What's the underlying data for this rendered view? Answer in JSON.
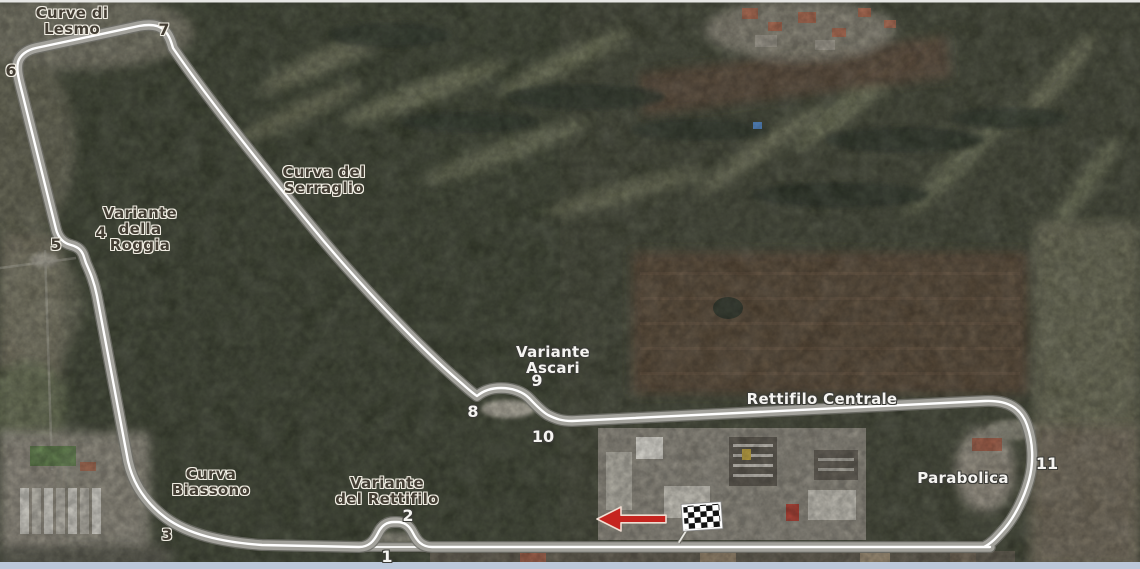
{
  "map": {
    "circuit_labels": [
      {
        "id": "curve-di-lesmo",
        "style": "dark",
        "lines": [
          "Curve di",
          "Lesmo"
        ]
      },
      {
        "id": "variante-della-roggia",
        "style": "dark",
        "lines": [
          "Variante",
          "della",
          "Roggia"
        ]
      },
      {
        "id": "curva-del-serraglio",
        "style": "dark",
        "lines": [
          "Curva del",
          "Serraglio"
        ]
      },
      {
        "id": "variante-ascari",
        "style": "light",
        "lines": [
          "Variante",
          "Ascari"
        ]
      },
      {
        "id": "rettifilo-centrale",
        "style": "light",
        "lines": [
          "Rettifilo Centrale"
        ]
      },
      {
        "id": "parabolica",
        "style": "light",
        "lines": [
          "Parabolica"
        ]
      },
      {
        "id": "curva-biassono",
        "style": "dark",
        "lines": [
          "Curva",
          "Biassono"
        ]
      },
      {
        "id": "variante-del-rettifilo",
        "style": "dark",
        "lines": [
          "Variante",
          "del Rettifilo"
        ]
      }
    ],
    "turn_numbers": [
      {
        "label": "1",
        "style": "light"
      },
      {
        "label": "2",
        "style": "light"
      },
      {
        "label": "3",
        "style": "dark"
      },
      {
        "label": "4",
        "style": "dark"
      },
      {
        "label": "5",
        "style": "dark"
      },
      {
        "label": "6",
        "style": "dark"
      },
      {
        "label": "7",
        "style": "dark"
      },
      {
        "label": "8",
        "style": "light"
      },
      {
        "label": "9",
        "style": "light"
      },
      {
        "label": "10",
        "style": "light"
      },
      {
        "label": "11",
        "style": "light"
      }
    ],
    "markers": {
      "finish_flag": "checkered-flag",
      "race_direction": "left"
    },
    "colors": {
      "track_road": "#a3a29c",
      "track_edge": "#6f6f68",
      "track_line": "#ffffff",
      "arrow_red": "#c5241f",
      "label_dark": "#433d33",
      "label_light": "#f5f4f1",
      "forest_green": "#3b4130",
      "field_brown": "#564636",
      "bottom_border": "#bcc8da"
    }
  }
}
